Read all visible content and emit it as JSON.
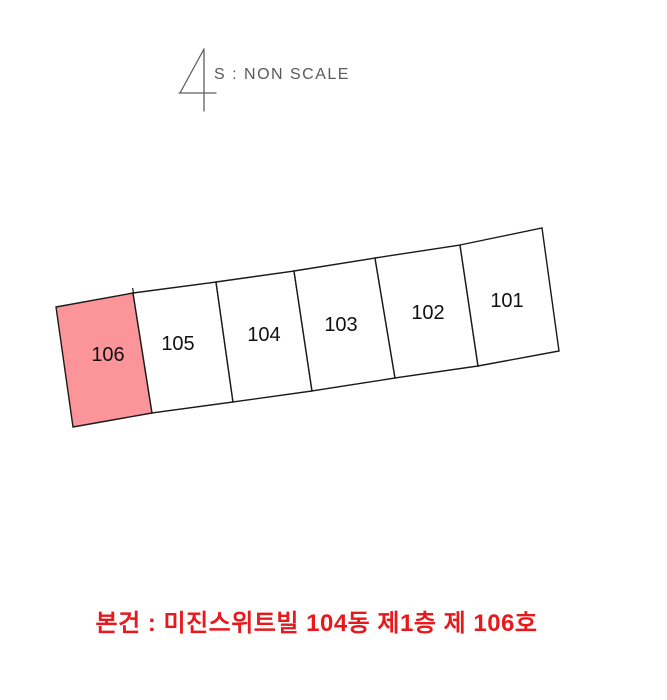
{
  "scale_note": {
    "symbol": "numeral-4-north-mark",
    "label": "S : NON SCALE",
    "color": "#5a5a5a"
  },
  "plan": {
    "units": [
      {
        "label": "106",
        "highlighted": true
      },
      {
        "label": "105",
        "highlighted": false
      },
      {
        "label": "104",
        "highlighted": false
      },
      {
        "label": "103",
        "highlighted": false
      },
      {
        "label": "102",
        "highlighted": false
      },
      {
        "label": "101",
        "highlighted": false
      }
    ],
    "highlight_color": "#fb9599",
    "outline_color": "#1a1a1a"
  },
  "caption": {
    "text": "본건 : 미진스위트빌 104동 제1층 제 106호",
    "color": "#e8191d"
  }
}
